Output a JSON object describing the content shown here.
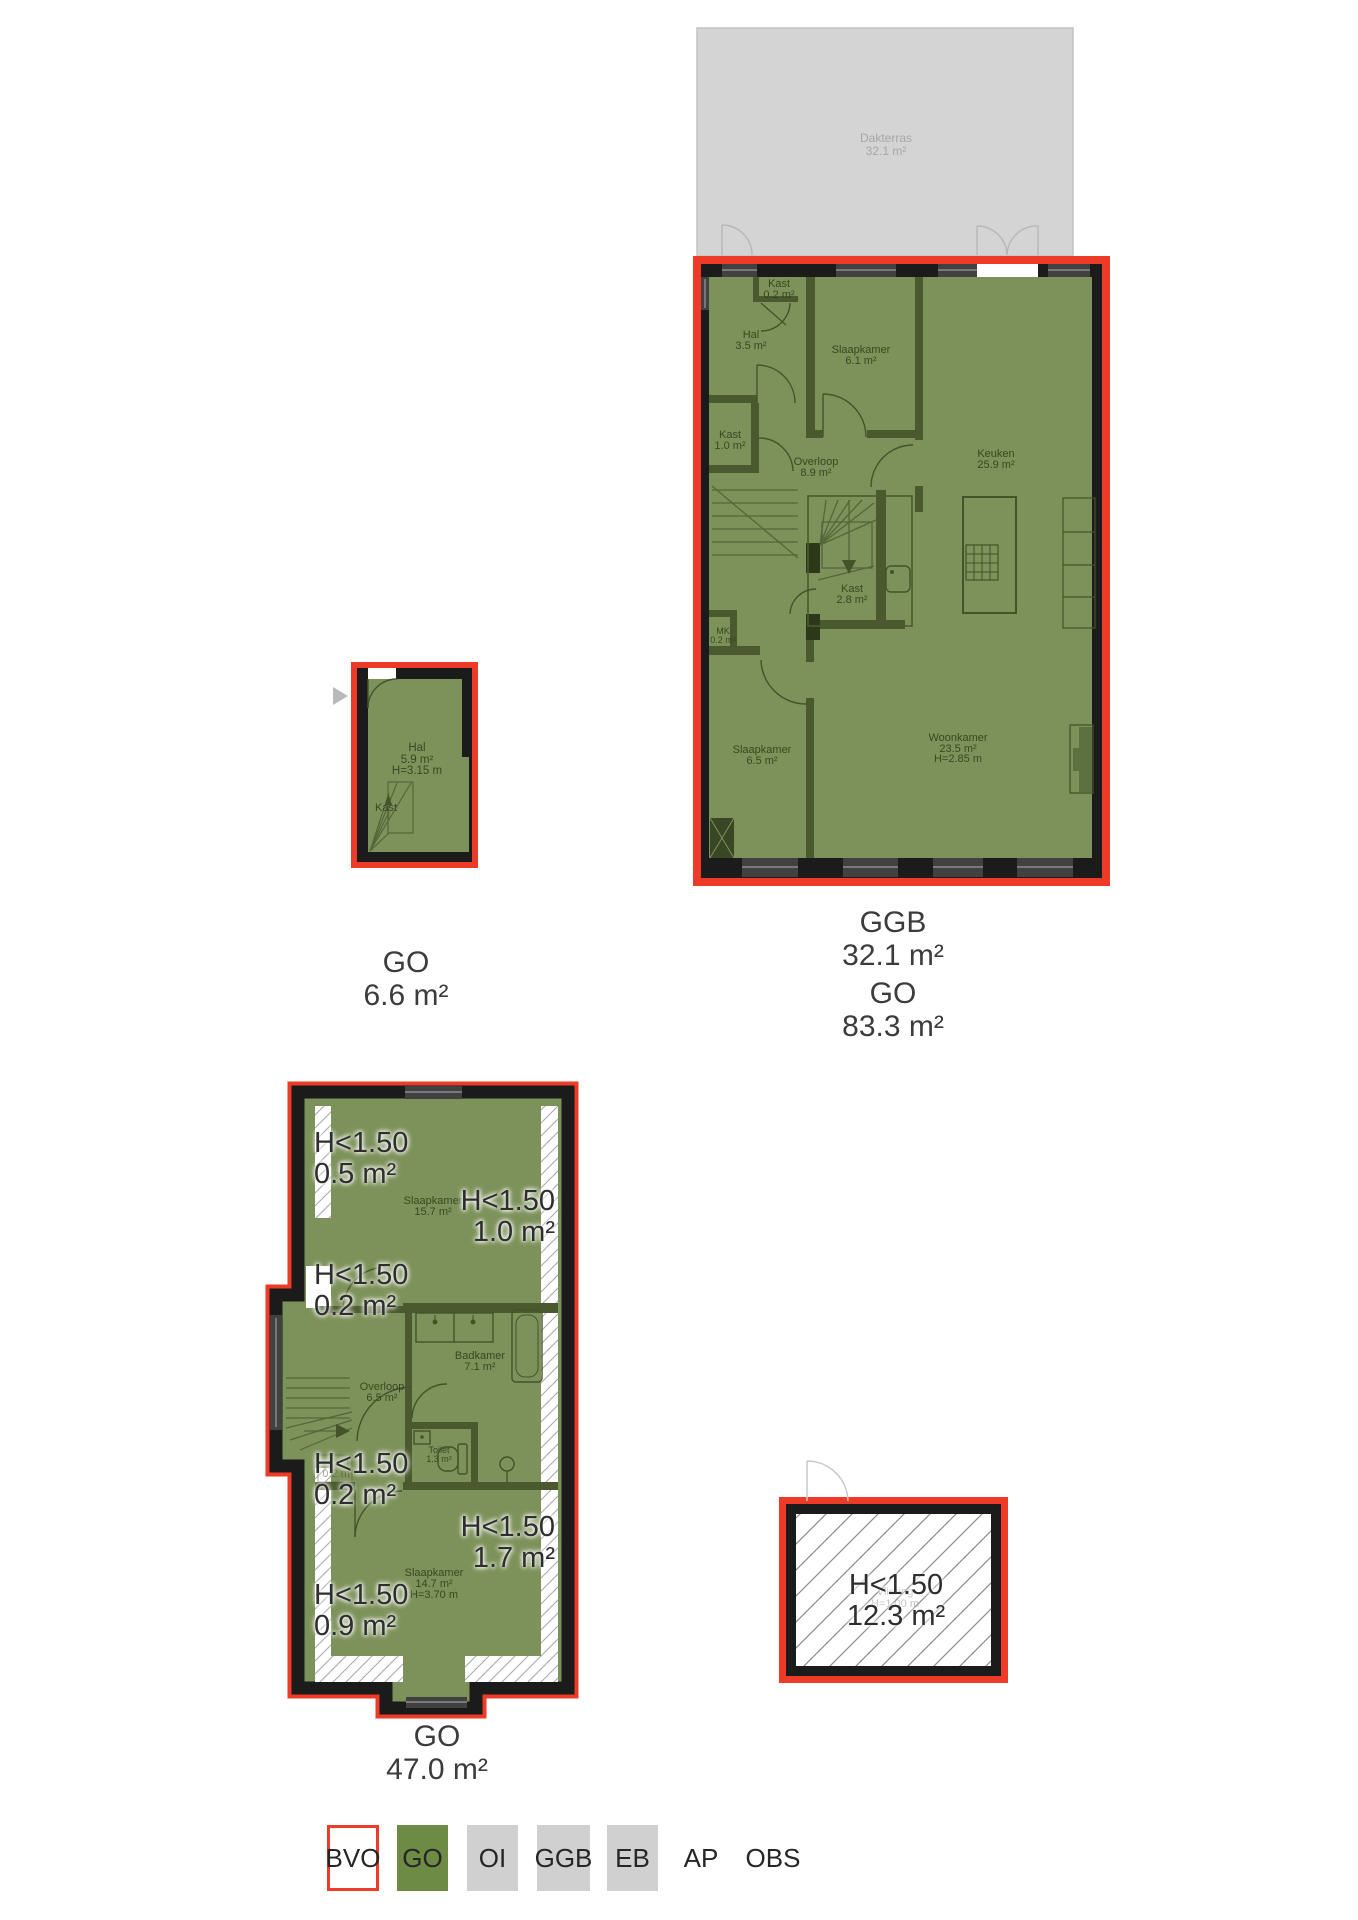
{
  "colors": {
    "go_green": "#7d915a",
    "legend_green": "#6e8b45",
    "wall_black": "#1b1b1b",
    "bvo_red": "#ee3b27",
    "ggb_grey": "#d4d4d4",
    "legend_grey": "#d0d0d0"
  },
  "upper_plan": {
    "terrace": {
      "name": "Dakterras",
      "area": "32.1 m²"
    },
    "rooms": [
      {
        "name": "Kast",
        "area": "0.2 m²"
      },
      {
        "name": "Hal",
        "area": "3.5 m²"
      },
      {
        "name": "Slaapkamer",
        "area": "6.1 m²"
      },
      {
        "name": "Kast",
        "area": "1.0 m²"
      },
      {
        "name": "Overloop",
        "area": "8.9 m²"
      },
      {
        "name": "Keuken",
        "area": "25.9 m²"
      },
      {
        "name": "Kast",
        "area": "2.8 m²"
      },
      {
        "name": "MK",
        "area": "0.2 m²"
      },
      {
        "name": "Slaapkamer",
        "area": "6.5 m²"
      },
      {
        "name": "Woonkamer",
        "area": "23.5 m²",
        "height": "H=2.85 m"
      }
    ],
    "summary": [
      {
        "code": "GGB",
        "value": "32.1 m²"
      },
      {
        "code": "GO",
        "value": "83.3 m²"
      }
    ]
  },
  "entry_plan": {
    "rooms": [
      {
        "name": "Hal",
        "area": "5.9 m²",
        "height": "H=3.15 m"
      },
      {
        "name": "Kast"
      }
    ],
    "summary": [
      {
        "code": "GO",
        "value": "6.6 m²"
      }
    ]
  },
  "attic_plan": {
    "rooms": [
      {
        "name": "Slaapkamer",
        "area": "15.7 m²"
      },
      {
        "name": "Badkamer",
        "area": "7.1 m²"
      },
      {
        "name": "Overloop",
        "area": "6.5 m²"
      },
      {
        "name": "Toilet",
        "area": "1.3 m²"
      },
      {
        "name": "Kast",
        "area": "0.2 m²"
      },
      {
        "name": "Slaapkamer",
        "area": "14.7 m²",
        "height": "H=3.70 m"
      }
    ],
    "low_clearance": [
      {
        "label": "H<1.50",
        "area": "0.5 m²"
      },
      {
        "label": "H<1.50",
        "area": "1.0 m²"
      },
      {
        "label": "H<1.50",
        "area": "0.2 m²"
      },
      {
        "label": "H<1.50",
        "area": "0.2 m²"
      },
      {
        "label": "H<1.50",
        "area": "1.7 m²"
      },
      {
        "label": "H<1.50",
        "area": "0.9 m²"
      }
    ],
    "summary": [
      {
        "code": "GO",
        "value": "47.0 m²"
      }
    ]
  },
  "loft_box": {
    "label": {
      "text": "H<1.50",
      "area": "12.3 m²"
    },
    "faint": {
      "name": "Vliering",
      "height": "H=1.00 m"
    }
  },
  "legend": {
    "items": [
      {
        "code": "BVO"
      },
      {
        "code": "GO"
      },
      {
        "code": "OI"
      },
      {
        "code": "GGB"
      },
      {
        "code": "EB"
      },
      {
        "code": "AP"
      },
      {
        "code": "OBS"
      }
    ]
  }
}
